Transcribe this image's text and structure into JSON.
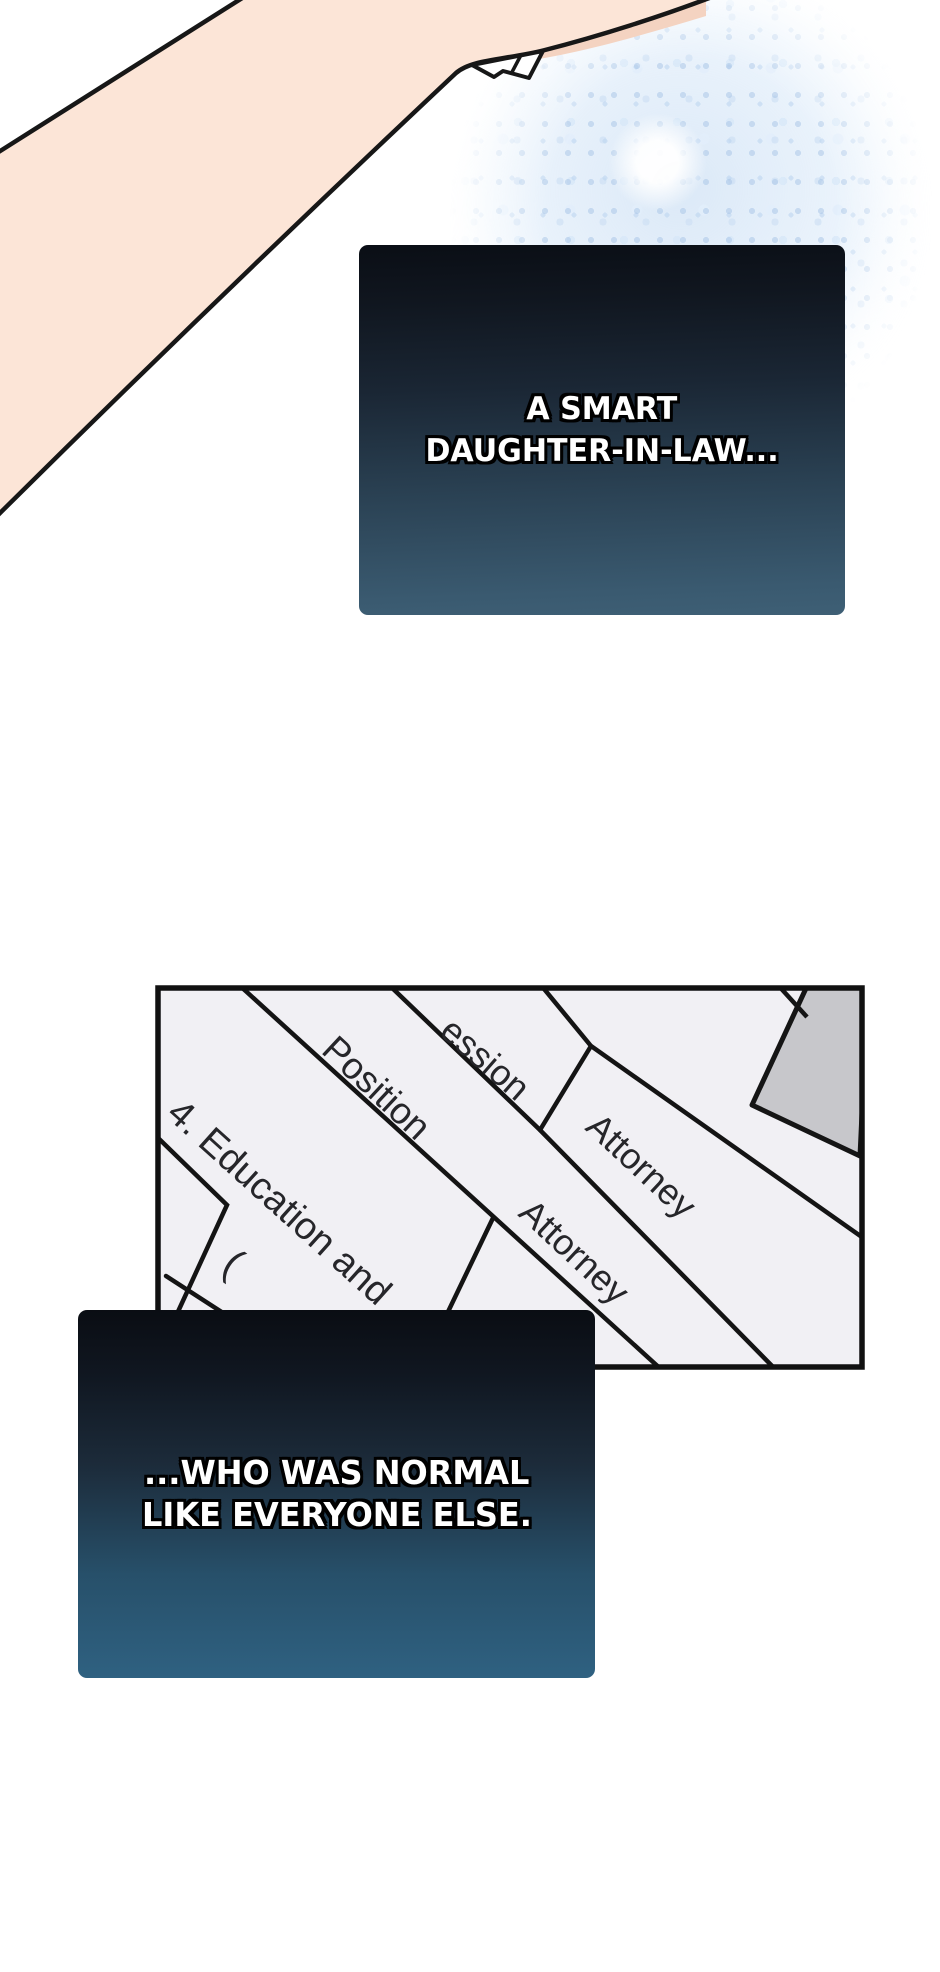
{
  "narration_box_1": {
    "line1": "A SMART",
    "line2": "DAUGHTER-IN-LAW..."
  },
  "narration_box_2": {
    "line1": "...WHO WAS NORMAL",
    "line2": "LIKE EVERYONE ELSE."
  },
  "document": {
    "profession_label_partial": "ession",
    "profession_value": "Attorney",
    "position_label": "Position",
    "position_value": "Attorney",
    "section_heading_partial": "4. Education and",
    "parenthesis_mark": "("
  },
  "colors": {
    "narration_gradient_top": "#0a0e15",
    "narration_gradient_bottom_box1": "#3e5f75",
    "narration_gradient_bottom_box2": "#2f6181",
    "narration_text": "#ffffff",
    "skin": "#fce5d7",
    "skin_shadow": "#f4d3c1",
    "line_art": "#171717",
    "paper": "#f1f0f4",
    "paper_line": "#141414",
    "gray_paper_corner": "#c7c7cb",
    "sparkle_tint": "#cfe0f2"
  }
}
